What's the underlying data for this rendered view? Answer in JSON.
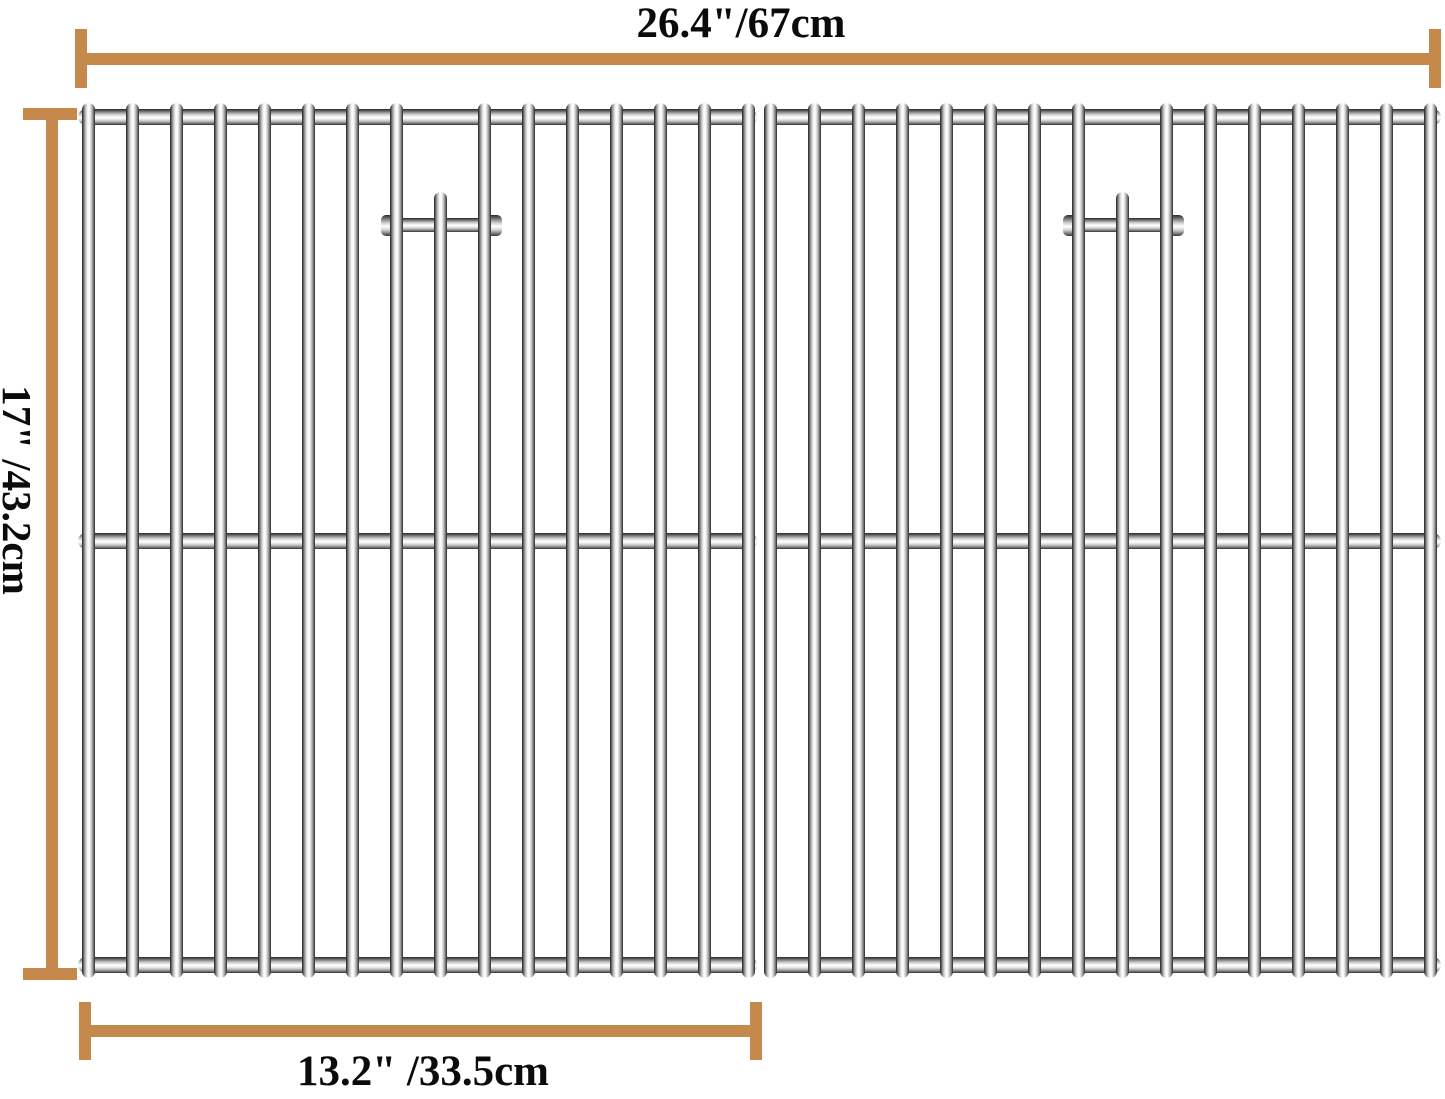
{
  "labels": {
    "total_width": "26.4\"/67cm",
    "height": "17\" /43.2cm",
    "single_width": "13.2\" /33.5cm"
  },
  "colors": {
    "dimension_line": "#C6894C",
    "text": "#0b0b0b",
    "background": "#ffffff"
  },
  "grate": {
    "bar_width": 13,
    "bar_top_y": 103,
    "bar_bottom_y": 978,
    "handle_bar_top_y": 192,
    "rods_y": [
      109,
      533,
      957
    ],
    "rod_height": 16,
    "handle_cross_y": 218,
    "handle_cross_height": 14,
    "panels": [
      {
        "rod_x1": 78,
        "rod_x2": 757,
        "first_bar_center": 88,
        "bar_spacing": 44,
        "bar_count": 16,
        "handle_bar_index": 8,
        "handle_cross_x1": 383,
        "handle_cross_x2": 500
      },
      {
        "rod_x1": 764,
        "rod_x2": 1441,
        "first_bar_center": 770,
        "bar_spacing": 44,
        "bar_count": 16,
        "handle_bar_index": 8,
        "handle_cross_x1": 1065,
        "handle_cross_x2": 1182
      }
    ]
  }
}
